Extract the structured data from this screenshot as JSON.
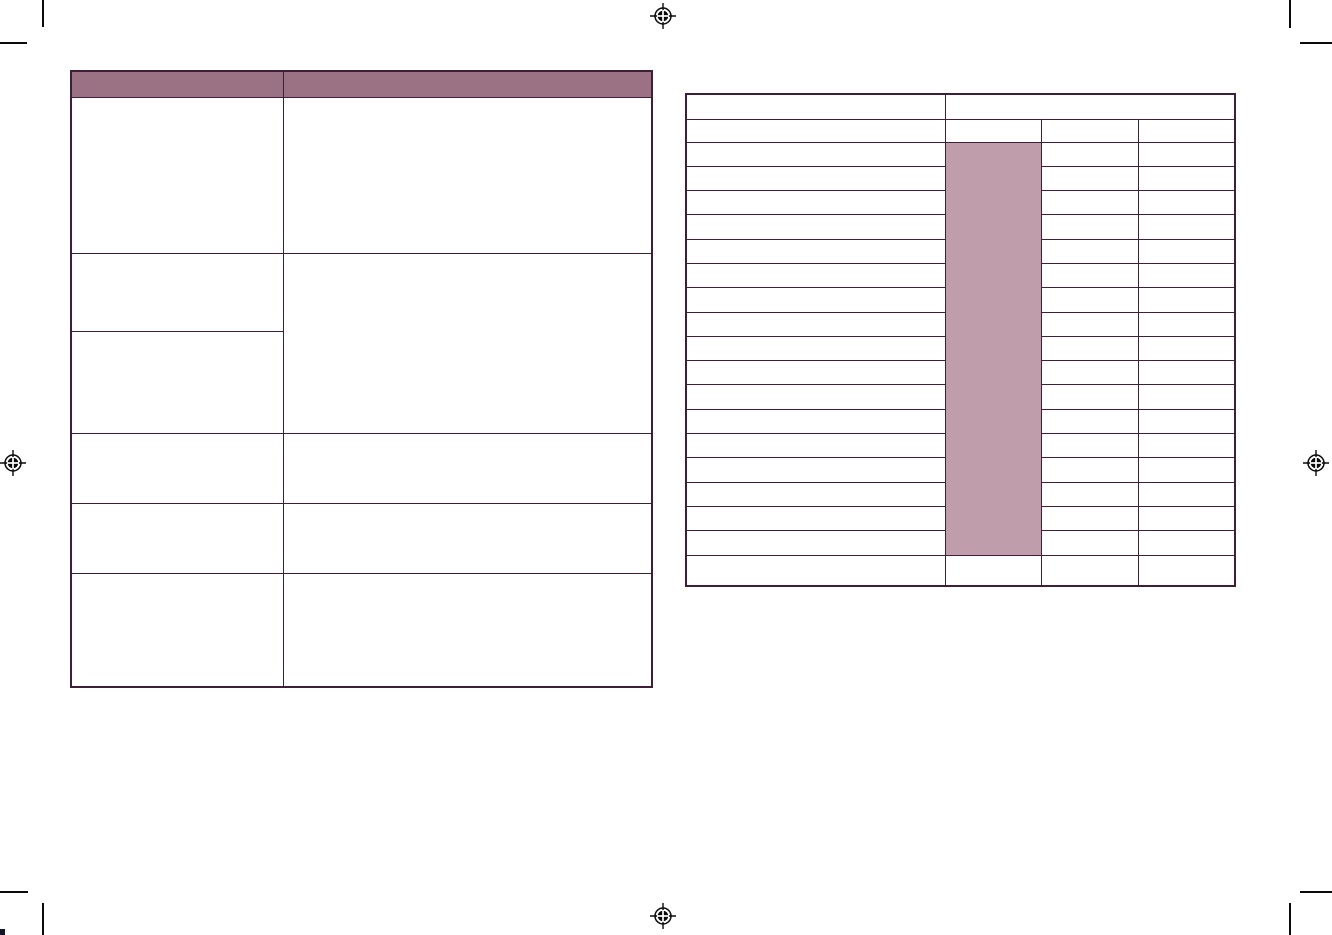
{
  "document": {
    "kind": "print-proof page spread with two empty tables",
    "page_width": 1332,
    "page_height": 935,
    "background": "#ffffff"
  },
  "colors": {
    "table_border": "#3f1e38",
    "header_fill": "#9b7284",
    "highlight_fill": "#bf9dab",
    "mark_color": "#0a0a0a"
  },
  "left_table": {
    "x": 70,
    "y": 70,
    "width": 581,
    "height": 616,
    "column_widths": [
      212,
      369
    ],
    "header_row_height": 26,
    "header_labels": [
      "",
      ""
    ],
    "row_heights": [
      156,
      78,
      102,
      70,
      70,
      114
    ],
    "merged_right_cell_spans_rows": [
      2,
      3
    ],
    "all_cells_empty": true
  },
  "right_table": {
    "x": 685,
    "y": 93,
    "width": 549,
    "height": 492,
    "column_widths": [
      259,
      96,
      97,
      97
    ],
    "header_row_1_height": 25,
    "header_row_1_cells": [
      "",
      ""
    ],
    "header_row_2_height": 23,
    "header_row_2_cells": [
      "",
      "",
      "",
      ""
    ],
    "body_row_count": 17,
    "body_row_height": 24.3,
    "footer_row_height": 31,
    "highlight_column_index": 1,
    "highlight_merged_rows": 17,
    "all_cells_empty": true
  },
  "registration_marks": [
    {
      "id": "top-center",
      "cx": 663,
      "cy": 16
    },
    {
      "id": "left-middle",
      "cx": 13,
      "cy": 463
    },
    {
      "id": "right-middle",
      "cx": 1316,
      "cy": 463
    },
    {
      "id": "bottom-center",
      "cx": 663,
      "cy": 916
    }
  ],
  "crop_marks": {
    "top_left": {
      "v": {
        "x": 42,
        "y": 0,
        "len": 27
      },
      "h": {
        "x": 0,
        "y": 42,
        "len": 27
      }
    },
    "top_right": {
      "v": {
        "x": 1289,
        "y": 0,
        "len": 28
      },
      "h": {
        "x": 1300,
        "y": 42,
        "len": 32
      }
    },
    "bottom_left": {
      "v": {
        "x": 42,
        "y": 903,
        "len": 32
      },
      "h": {
        "x": 0,
        "y": 891,
        "len": 28
      }
    },
    "bottom_right": {
      "v": {
        "x": 1289,
        "y": 903,
        "len": 32
      },
      "h": {
        "x": 1300,
        "y": 891,
        "len": 32
      }
    }
  }
}
